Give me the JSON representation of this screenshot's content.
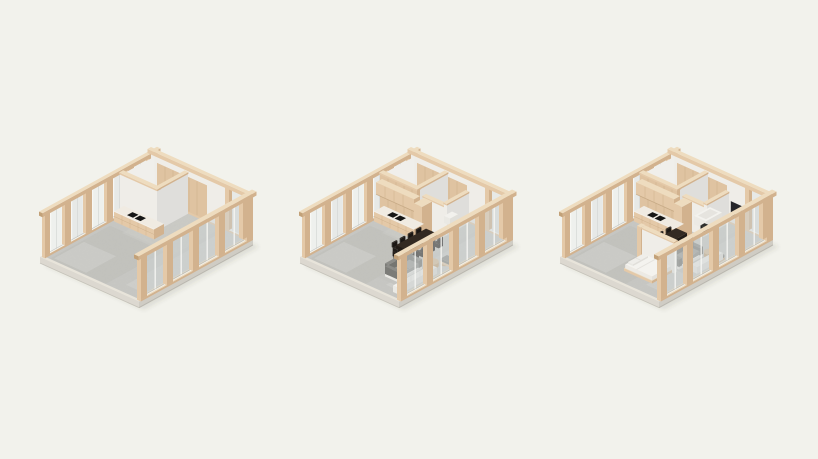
{
  "page": {
    "background": "#f2f2ec",
    "description": "three isometric architectural cutaway renders of a timber-and-glass room interior shown in three furnishing stages"
  },
  "scene": {
    "projection": "isometric-axonometric",
    "palette": {
      "background": "#f2f2ec",
      "woodTop": "#eedcbf",
      "woodLight": "#e4c9a8",
      "woodMid": "#d2b28e",
      "woodDark": "#c2a178",
      "plywood": "#dfc3a1",
      "plywoodGrain": "#cbab85",
      "floor": "#c8c8c4",
      "floorLight": "#d4d4d0",
      "floorDark": "#bdbdb9",
      "rug": "#c3c3bf",
      "whiteTop": "#f6f5f1",
      "whiteLight": "#efede8",
      "whiteShade": "#dfdedb",
      "glassBack": "#e7e9e7",
      "glassWhite": "#eef0ed",
      "glassFront": "rgba(204,210,210,0.5)",
      "frameWhite": "#f8f8f5",
      "slabSide": "#dcd8d0",
      "slabFront": "#cfccc4",
      "slabRim": "#e8e4da",
      "shadow": "rgba(70,70,60,0.12)",
      "counterTop": "#f0ebe2",
      "cooktop": "#161616",
      "tableDark": "#332a22",
      "tableSide": "#221c17",
      "chairDark": "#26211d",
      "sofaBack": "#82827e",
      "sofaSeat": "#9c9c98",
      "sofaBase": "#f2f1ed",
      "benchCushion": "#8f8f8b",
      "mattress": "#f4f3ef",
      "mattressSide": "#eceae5",
      "pillow": "#efeeea",
      "tub": "#f3f2ee",
      "fixtureDark": "#2b2b29",
      "tvDark": "#26262a"
    },
    "rooms": [
      {
        "id": "room-1",
        "name": "empty shell with kitchen core",
        "features": [
          "shell",
          "corner-room",
          "kitchen-counter",
          "cooktop"
        ]
      },
      {
        "id": "room-2",
        "name": "shell furnished with living and dining",
        "features": [
          "shell",
          "corner-room",
          "corner-room-wood",
          "bathroom",
          "bath-sink",
          "kitchen-counter",
          "cooktop",
          "upper-cabinets",
          "tall-cabinet",
          "rug",
          "dining-set",
          "sofa-set",
          "coffee-tables",
          "bench",
          "sideboard"
        ]
      },
      {
        "id": "room-3",
        "name": "full apartment with bedroom and bath",
        "features": [
          "shell",
          "corner-room",
          "corner-room-wood",
          "bathroom",
          "bathtub",
          "bath-fixture",
          "kitchen-counter",
          "cooktop",
          "upper-cabinets",
          "tall-cabinet",
          "rug",
          "dining-set",
          "sofa-set",
          "coffee-tables",
          "bench",
          "sideboard",
          "bed-nook",
          "wall-tv"
        ]
      }
    ]
  }
}
